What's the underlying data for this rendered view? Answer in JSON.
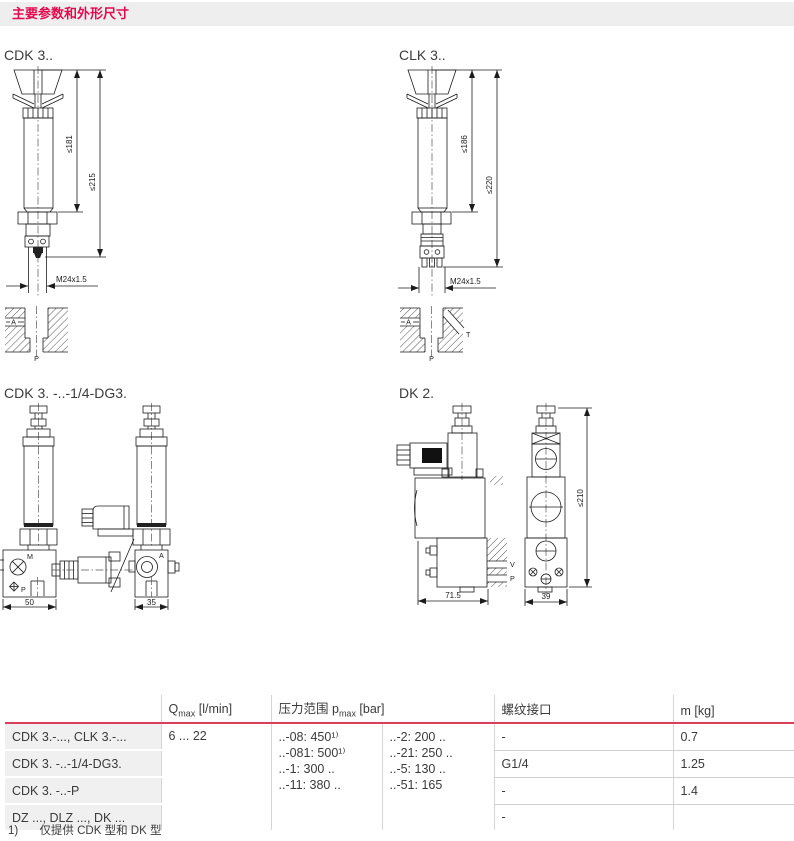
{
  "header": {
    "title": "主要参数和外形尺寸"
  },
  "figures": {
    "cdk3": {
      "label": "CDK 3..",
      "dims": {
        "inner": "≤181",
        "outer": "≤215",
        "thread": "M24x1.5"
      },
      "ports": {
        "a": "A",
        "p": "P"
      }
    },
    "clk3": {
      "label": "CLK 3..",
      "dims": {
        "inner": "≤186",
        "outer": "≤220",
        "thread": "M24x1.5"
      },
      "ports": {
        "a": "A",
        "p": "P",
        "t": "T"
      }
    },
    "cdk3_dg3": {
      "label": "CDK 3. -..-1/4-DG3.",
      "dims": {
        "left_width": "50",
        "right_width": "35"
      },
      "ports": {
        "m": "M",
        "p": "P",
        "a": "A"
      }
    },
    "dk2": {
      "label": "DK 2.",
      "dims": {
        "left_width": "71.5",
        "right_width": "39",
        "height": "≤210"
      },
      "ports": {
        "v": "V",
        "p": "P"
      }
    }
  },
  "table": {
    "headers": {
      "qmax": {
        "main": "Q",
        "sub": "max",
        "unit": " [l/min]"
      },
      "pressure": {
        "main": "压力范围 p",
        "sub": "max",
        "unit": " [bar]"
      },
      "thread": "螺纹接口",
      "mass": "m [kg]"
    },
    "qmax_value": "6 ... 22",
    "pressure_col_a": [
      "..-08: 450¹⁾",
      "..-081: 500¹⁾",
      "..-1: 300 ..",
      "..-11: 380 .."
    ],
    "pressure_col_b": [
      "..-2: 200 ..",
      "..-21: 250 ..",
      "..-5: 130 ..",
      "..-51: 165"
    ],
    "rows": [
      {
        "label": "CDK 3.-..., CLK 3.-...",
        "thread": "-",
        "mass": "0.7"
      },
      {
        "label": "CDK 3. -..-1/4-DG3.",
        "thread": "G1/4",
        "mass": "1.25"
      },
      {
        "label": "CDK 3. -..-P",
        "thread": "-",
        "mass": "1.4"
      },
      {
        "label": "DZ ..., DLZ ..., DK ...",
        "thread": "-",
        "mass": ""
      }
    ]
  },
  "footnote": {
    "marker": "1)",
    "text": "仅提供 CDK 型和 DK 型"
  },
  "colors": {
    "accent_red": "#e30a4e",
    "table_rule_red": "#dd3d5c",
    "label_bg": "#f0f0f0",
    "header_bar_bg": "#eeeeee"
  }
}
